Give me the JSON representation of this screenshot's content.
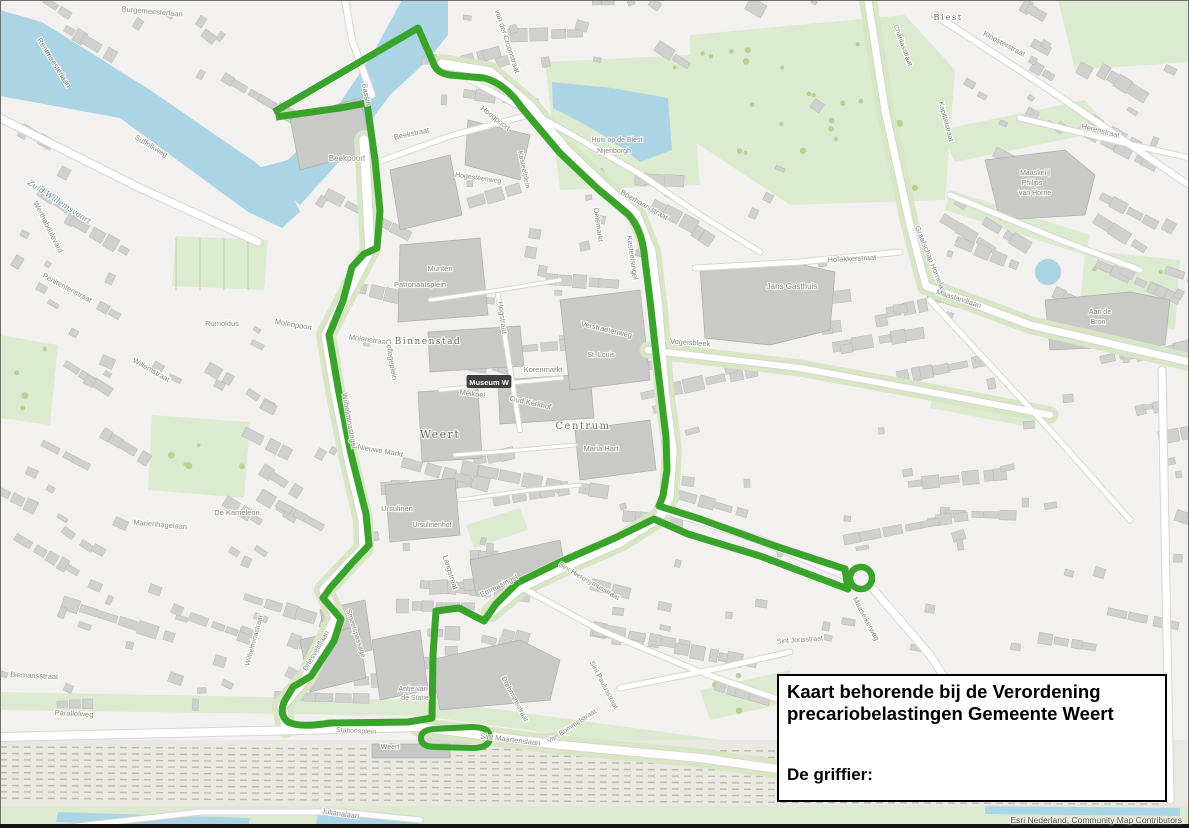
{
  "title_box": {
    "line1": "Kaart behorende bij de Verordening",
    "line2": "precariobelastingen Gemeente Weert",
    "signature_label": "De griffier:"
  },
  "map": {
    "attribution": "Esri Nederland, Community Map Contributors",
    "colors": {
      "zone_boundary_green": "#3aa32b",
      "water_blue": "#abd4e4",
      "park_green": "#dcead0",
      "building_gray": "#d0d0ce",
      "road_white": "#ffffff",
      "label_gray": "#8a8a88"
    },
    "zone_boundary": {
      "main": "M274,112 L418,28 L433,62 Q436,73 450,75 L484,78 Q505,83 522,108 L560,153 L598,189 L628,214 Q641,228 644,252 L650,300 L655,345 L661,395 L666,437 L667,470 L663,496 L659,506 L700,519 L775,546 L845,569 L848,589 L760,556 L688,534 L654,519 L615,538 L558,563 L517,583 L496,604 L484,621 L459,608 L436,611 L433,655 L432,718 L408,722 L330,723 Q300,728 288,722 Q279,715 284,702 L293,687 L311,676 L334,641 L341,619 L323,598 L331,587 L353,562 L369,545 L366,514 L351,454 L339,393 L329,335 L343,301 L352,267 L364,254 L377,248 L380,211 L375,160 L367,103 L340,108 L276,117",
      "station_loop": "M434,729 L472,727 Q490,727 490,737 Q490,748 472,748 L436,747 Q421,747 421,738 Q421,730 434,729 Z",
      "roundabout": {
        "cx": 861,
        "cy": 578,
        "r": 11
      }
    },
    "labels": [
      [
        "Burgemeesterlaan",
        152,
        14,
        5,
        7.5,
        0
      ],
      [
        "Rentmeesterlaan",
        52,
        64,
        58,
        7.5,
        0
      ],
      [
        "Zuid-Willemsvaart",
        58,
        204,
        33,
        8,
        2
      ],
      [
        "Werthaboulevard",
        46,
        228,
        63,
        7.5,
        0
      ],
      [
        "Suffolkweg",
        150,
        148,
        31,
        7.5,
        0
      ],
      [
        "Penitentenstraat",
        66,
        290,
        28,
        7.5,
        0
      ],
      [
        "Willemstraat",
        150,
        372,
        30,
        7.5,
        0
      ],
      [
        "Biemansstraat",
        34,
        678,
        3,
        7.5,
        0
      ],
      [
        "Parallelweg",
        74,
        716,
        3,
        7.5,
        0
      ],
      [
        "Julianalaan",
        340,
        816,
        8,
        7.5,
        0
      ],
      [
        "Wilhelminastraat",
        256,
        641,
        -75,
        7,
        0
      ],
      [
        "Driesveldlaan",
        318,
        652,
        -60,
        7.5,
        0
      ],
      [
        "Smeetspassage",
        354,
        634,
        72,
        7,
        0
      ],
      [
        "Stationsplein",
        356,
        733,
        3,
        7,
        0
      ],
      [
        "Weert",
        390,
        749,
        0,
        7,
        0
      ],
      [
        "Antje van",
        413,
        691,
        0,
        7,
        0
      ],
      [
        "de Statie",
        415,
        700,
        0,
        7,
        0
      ],
      [
        "Sint Maartenslaan",
        510,
        742,
        7,
        7.5,
        0
      ],
      [
        "Van Bommelstraat",
        573,
        728,
        -33,
        7,
        0
      ],
      [
        "Drehmansstraat",
        513,
        700,
        62,
        7,
        0
      ],
      [
        "Sint Paulusstraat",
        602,
        686,
        62,
        7,
        0
      ],
      [
        "Sint Hieronymusstraat",
        588,
        583,
        30,
        7,
        0
      ],
      [
        "Sint Jorisstraat",
        800,
        642,
        -4,
        7,
        0
      ],
      [
        "Emmasingel",
        500,
        588,
        -27,
        7.5,
        0
      ],
      [
        "Langstraat",
        448,
        573,
        72,
        7.5,
        0
      ],
      [
        "Ursulinen",
        397,
        511,
        0,
        7.5,
        0
      ],
      [
        "Ursulinenhof",
        432,
        527,
        0,
        7,
        0
      ],
      [
        "Nieuwe Markt",
        380,
        453,
        10,
        7.5,
        0
      ],
      [
        "Wilhelminasingel",
        347,
        421,
        80,
        7.5,
        0
      ],
      [
        "Weert",
        440,
        438,
        0,
        11,
        1
      ],
      [
        "Binnenstad",
        428,
        344,
        0,
        9,
        1
      ],
      [
        "Centrum",
        583,
        429,
        0,
        10,
        1
      ],
      [
        "Maria Hart",
        601,
        451,
        0,
        7.5,
        0
      ],
      [
        "Oud Kerkhof",
        530,
        405,
        12,
        7.5,
        0
      ],
      [
        "Korenmarkt",
        543,
        372,
        0,
        7.5,
        0
      ],
      [
        "Meikoel",
        472,
        396,
        8,
        7.5,
        0
      ],
      [
        "Hegstraat",
        500,
        318,
        82,
        7.5,
        0
      ],
      [
        "Molenstraat",
        368,
        342,
        8,
        7.5,
        0
      ],
      [
        "Collegeplein",
        389,
        360,
        80,
        7.5,
        0
      ],
      [
        "Patronaatsplein",
        420,
        287,
        0,
        7.5,
        0
      ],
      [
        "Munten",
        440,
        271,
        0,
        7.5,
        0
      ],
      [
        "Molenpoort",
        293,
        327,
        10,
        7.5,
        0
      ],
      [
        "Rumoldus",
        222,
        326,
        0,
        7.5,
        0
      ],
      [
        "Beekpoort",
        347,
        161,
        0,
        8,
        0
      ],
      [
        "Bassin",
        364,
        95,
        80,
        7.5,
        0
      ],
      [
        "Beekstraat",
        412,
        136,
        -12,
        7.5,
        0
      ],
      [
        "Hoogpoort",
        494,
        120,
        38,
        7.5,
        0
      ],
      [
        "van der Croonstraat",
        505,
        42,
        72,
        7.5,
        0
      ],
      [
        "Hogesteenweg",
        478,
        180,
        8,
        7,
        0
      ],
      [
        "Kasteelplein",
        522,
        170,
        78,
        7,
        0
      ],
      [
        "Oelemarkt",
        596,
        225,
        82,
        7.5,
        0
      ],
      [
        "Kasteelsingel",
        630,
        258,
        82,
        7.5,
        0
      ],
      [
        "Boerhaarsstraat",
        643,
        207,
        30,
        7.5,
        0
      ],
      [
        "Verstraetenweg",
        606,
        332,
        13,
        7.5,
        0
      ],
      [
        "St. Louis",
        601,
        357,
        0,
        7,
        0
      ],
      [
        "Vogelsbleek",
        690,
        345,
        4,
        7.5,
        0
      ],
      [
        "Huis op de Biest",
        617,
        142,
        0,
        7,
        0
      ],
      [
        "Nijenborgh",
        614,
        153,
        0,
        7,
        0
      ],
      [
        "Biest",
        948,
        20,
        0,
        8.5,
        1
      ],
      [
        "Kloosterstraat",
        1003,
        46,
        28,
        7.5,
        0
      ],
      [
        "Charitasstraat",
        901,
        46,
        70,
        7,
        0
      ],
      [
        "Kapittelstraat",
        944,
        122,
        75,
        7,
        0
      ],
      [
        "Herenstraat",
        1100,
        133,
        14,
        7.5,
        0
      ],
      [
        "Maaskei |",
        1035,
        175,
        0,
        7,
        0
      ],
      [
        "Philips",
        1032,
        185,
        0,
        7,
        0
      ],
      [
        "van Horne",
        1035,
        195,
        0,
        7,
        0
      ],
      [
        "Hofakkerstraat",
        852,
        261,
        -3,
        7.5,
        0
      ],
      [
        "Jans Gasthuis",
        792,
        289,
        0,
        8,
        0
      ],
      [
        "Graafschap Hornelaan",
        929,
        262,
        68,
        7.5,
        0
      ],
      [
        "Maaslandlaan",
        958,
        301,
        18,
        7.5,
        0
      ],
      [
        "Aan de",
        1100,
        314,
        0,
        7,
        0
      ],
      [
        "Bron",
        1098,
        324,
        0,
        7,
        0
      ],
      [
        "Maaseikerweg",
        864,
        620,
        62,
        7.5,
        0
      ],
      [
        "De Kameleon",
        237,
        515,
        0,
        7.5,
        0
      ],
      [
        "Marienhagelaan",
        160,
        527,
        5,
        7.5,
        0
      ],
      [
        "Museum W",
        489,
        382,
        0,
        7.5,
        3
      ]
    ]
  }
}
